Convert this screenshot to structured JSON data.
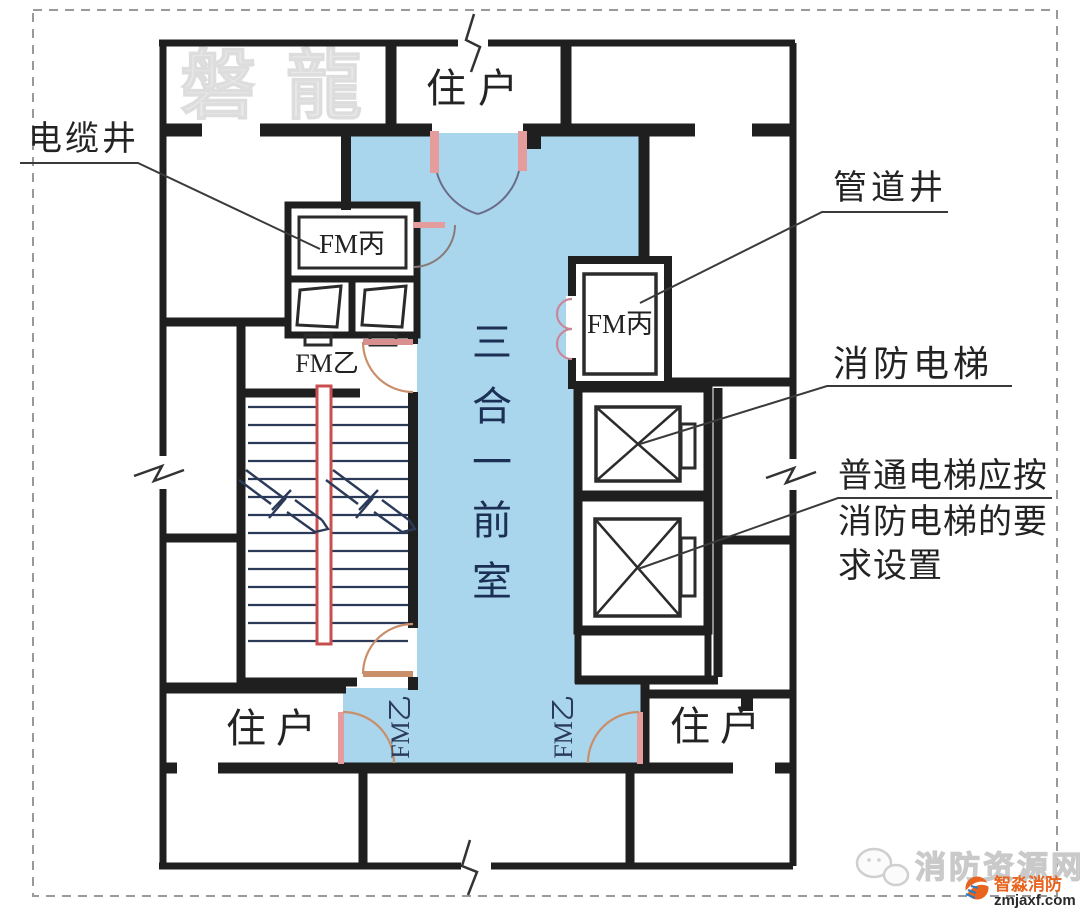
{
  "watermarks": {
    "brand_top_left": "磐龍",
    "site_name": "消防资源网",
    "logo_name": "智淼消防",
    "logo_domain": "zmjaxf.com"
  },
  "colors": {
    "corridor_fill": "#a9d6ec",
    "wall": "#1f1f1f",
    "stair_line": "#2b3a58",
    "handrail_red": "#c94f4f",
    "door_pink": "#e59c9c",
    "door_tan": "#c98f6a",
    "corridor_text": "#1c2f55",
    "watermark_gray": "#d9d9d9",
    "logo_orange": "#e8641e",
    "logo_blue": "#2b7bc4"
  },
  "plan": {
    "corridor_chars": [
      "三",
      "合",
      "一",
      "前",
      "室"
    ],
    "corridor_name": "三合一前室",
    "labels": {
      "unit_top": "住户",
      "unit_bottom_left": "住户",
      "unit_bottom_right": "住户",
      "door_cable_shaft": "FM丙",
      "door_pipe_shaft": "FM丙",
      "door_stair": "FM乙",
      "door_bottom_left": "FM乙",
      "door_bottom_right": "FM乙"
    },
    "annotations": {
      "cable_shaft": "电缆井",
      "pipe_shaft": "管道井",
      "fire_elevator": "消防电梯",
      "ordinary_elevator": [
        "普通电梯应按",
        "消防电梯的要",
        "求设置"
      ]
    }
  }
}
